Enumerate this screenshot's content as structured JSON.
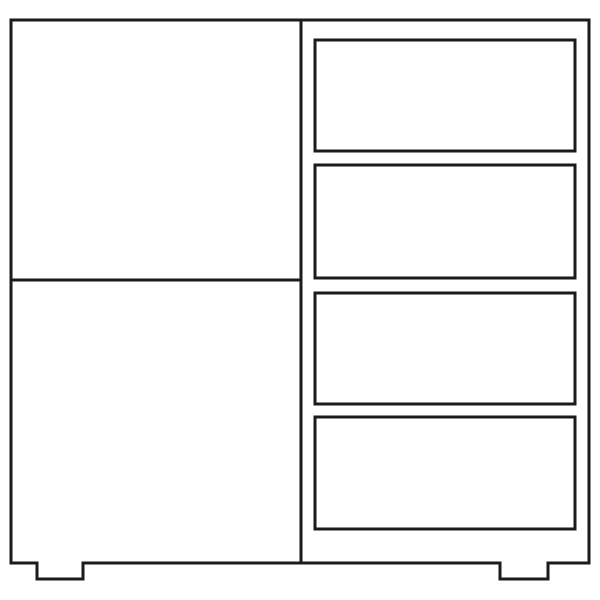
{
  "canvas": {
    "width": 600,
    "height": 600,
    "background_color": "#ffffff"
  },
  "drawing": {
    "description": "line drawing of a cabinet with two left door panels and four right drawers",
    "stroke_color": "#1b1b1b",
    "fill_color": "#ffffff",
    "stroke_width": 3,
    "body": {
      "left": 11,
      "top": 20,
      "right": 589,
      "bottom": 563
    },
    "feet": [
      {
        "x1": 37,
        "x2": 83,
        "bottom": 579
      },
      {
        "x1": 500,
        "x2": 548,
        "bottom": 579
      }
    ],
    "center_divider": {
      "x": 301,
      "y1": 20,
      "y2": 563
    },
    "left_panel_divider": {
      "y": 280,
      "x1": 11,
      "x2": 301
    },
    "drawers": [
      {
        "x": 315,
        "y": 40,
        "width": 260,
        "height": 111
      },
      {
        "x": 315,
        "y": 165,
        "width": 260,
        "height": 113
      },
      {
        "x": 315,
        "y": 293,
        "width": 260,
        "height": 111
      },
      {
        "x": 315,
        "y": 417,
        "width": 260,
        "height": 112
      }
    ]
  }
}
